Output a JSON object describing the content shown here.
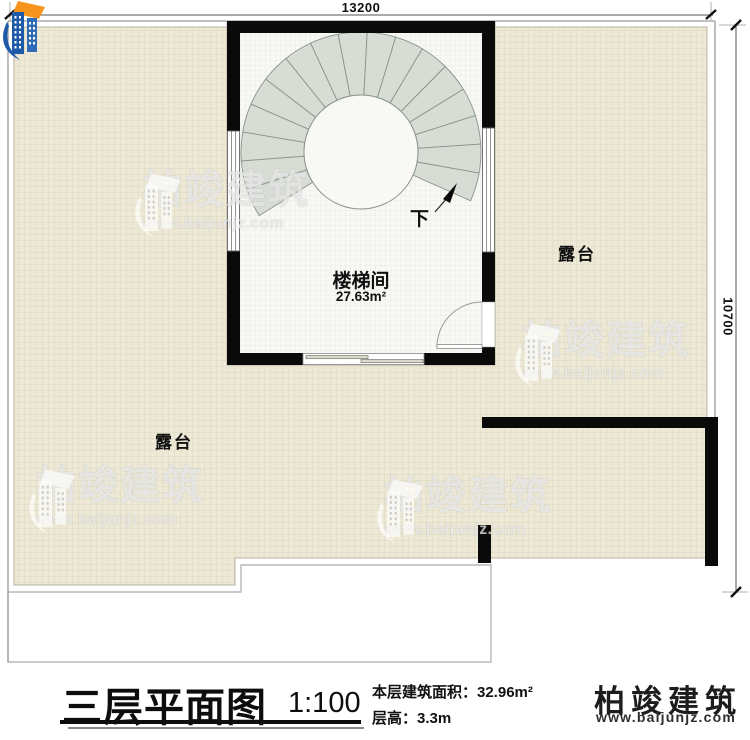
{
  "plan": {
    "dim_top": "13200",
    "dim_right": "10700",
    "stair_room": {
      "name": "楼梯间",
      "area": "27.63m²"
    },
    "terrace_left_label": "露台",
    "terrace_right_label": "露台",
    "stair_direction_label": "下"
  },
  "watermark": {
    "brand": "柏竣建筑",
    "url": "www.baijunjz.com"
  },
  "title_block": {
    "title": "三层平面图",
    "scale": "1:100",
    "area_line": "本层建筑面积：32.96m²",
    "height_line": "层高：3.3m",
    "brand": "柏竣建筑",
    "brand_url": "www.baijunjz.com"
  },
  "colors": {
    "terrace_fill": "#EDE9D6",
    "terrace_grid": "#DCD7BE",
    "room_fill": "#F8F8F4",
    "stair_tread": "#D7DDD5",
    "wall": "#0A0A0A",
    "logo_blue": "#1E5AA8",
    "logo_orange": "#F7941D"
  }
}
